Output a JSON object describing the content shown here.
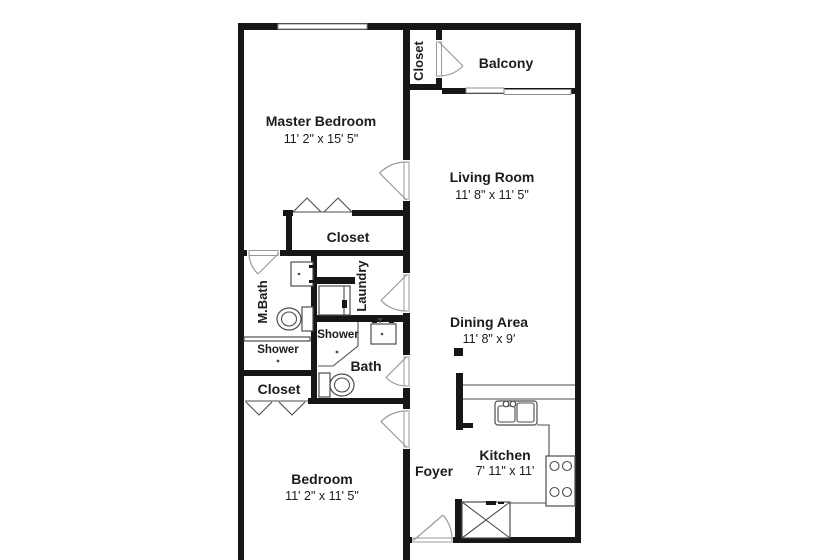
{
  "rooms": {
    "master_bedroom": {
      "name": "Master Bedroom",
      "dims": "11' 2\" x 15' 5\""
    },
    "living_room": {
      "name": "Living Room",
      "dims": "11' 8\" x 11' 5\""
    },
    "dining_area": {
      "name": "Dining Area",
      "dims": "11' 8\" x 9'"
    },
    "kitchen": {
      "name": "Kitchen",
      "dims": "7' 11\" x 11'"
    },
    "bedroom": {
      "name": "Bedroom",
      "dims": "11' 2\" x 11' 5\""
    },
    "balcony": {
      "name": "Balcony"
    },
    "foyer": {
      "name": "Foyer"
    },
    "closet_top": {
      "name": "Closet"
    },
    "closet_mid": {
      "name": "Closet"
    },
    "closet_lower": {
      "name": "Closet"
    },
    "laundry": {
      "name": "Laundry"
    },
    "mbath": {
      "name": "M.Bath"
    },
    "shower_mbath": {
      "name": "Shower"
    },
    "shower_bath": {
      "name": "Shower"
    },
    "bath": {
      "name": "Bath"
    }
  },
  "colors": {
    "wall": "#161616",
    "fixture_line": "#4d4d4d",
    "door_line": "#9a9a9a",
    "background": "#ffffff",
    "text": "#1c1c1c"
  }
}
